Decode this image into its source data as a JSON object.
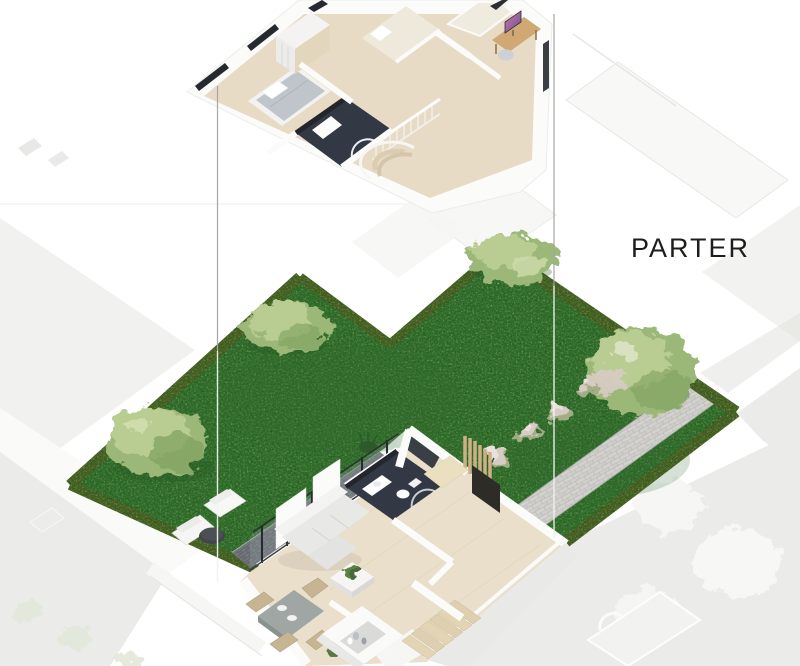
{
  "labels": {
    "floor": "PARTER"
  },
  "colors": {
    "bg": "#ffffff",
    "label": "#1d1d1b",
    "grass": "#3c7839",
    "grassDark": "#2c5a2a",
    "hedge": "#55672f",
    "treeLight": "#b9cd93",
    "treeMid": "#9cb878",
    "treeDark": "#7da05c",
    "blossom": "#d7ccc4",
    "pathBase": "#c6c5c1",
    "terrace": "#6a7074",
    "woodFloor": "#e9dfca",
    "woodFloorUpper": "#e7dbc5",
    "woodStep": "#e3d4b4",
    "darkTile": "#323944",
    "wallWhite": "#fbfbfa",
    "wallShade": "#e9e9e7",
    "windowFrame": "#26292e",
    "sofa": "#e8e8e6",
    "sofaBack": "#f3f3f1",
    "tableGray": "#9fa6a4",
    "wicker": "#c7b493",
    "slatWood": "#cdb184",
    "cabinetWood": "#eadfbe",
    "bedGray": "#c0c5cb",
    "bedCream": "#efe9db",
    "deskWood": "#cfa873",
    "monitorPinkA": "#cd7ba8",
    "monitorPinkB": "#6f4d92",
    "sideTable": "#41464a",
    "leader": "#a6a6a6",
    "leaderLight": "#f1f3ee",
    "ghostField": "#efefee",
    "ghostField2": "#ebebea",
    "ghostLine": "#e7e7e5",
    "ghostWhite": "#f8f8f7",
    "ghostGreen": "#e3e8dc"
  },
  "scene": {
    "type": "isometric-architectural-cutaway-render",
    "floors": [
      {
        "id": "upper-floor",
        "elements": [
          "bedroom-bed-gray",
          "bedroom-bed-cream",
          "bedroom-bed-cream-2",
          "wardrobe",
          "desk-with-pink-monitor",
          "desk-chair",
          "dark-tiled-bathroom",
          "glass-shower",
          "stair-railing",
          "spiral-stairs",
          "windows"
        ]
      },
      {
        "id": "ground-floor",
        "label": "PARTER",
        "elements": [
          "living-room-sofa",
          "coffee-table-with-plant",
          "dining-table-with-chairs",
          "kitchen-island-with-shelf",
          "dark-tiled-bathroom",
          "toilet",
          "vanity",
          "staircase",
          "glass-wall",
          "terrace",
          "entrance-door",
          "wood-slat-screen"
        ]
      }
    ],
    "garden": {
      "elements": [
        "lawn",
        "hedge-border",
        "large-tree-west",
        "tree-upper-left",
        "tree-north",
        "large-tree-east",
        "flowering-bushes",
        "ornamental-grasses",
        "paved-path",
        "white-lounge-chairs",
        "round-side-table"
      ]
    },
    "annotations": {
      "leader_line_count": 2
    },
    "background": {
      "elements": [
        "faded-neighbor-buildings",
        "faded-neighbor-garden-furniture",
        "faded-trees"
      ]
    }
  }
}
